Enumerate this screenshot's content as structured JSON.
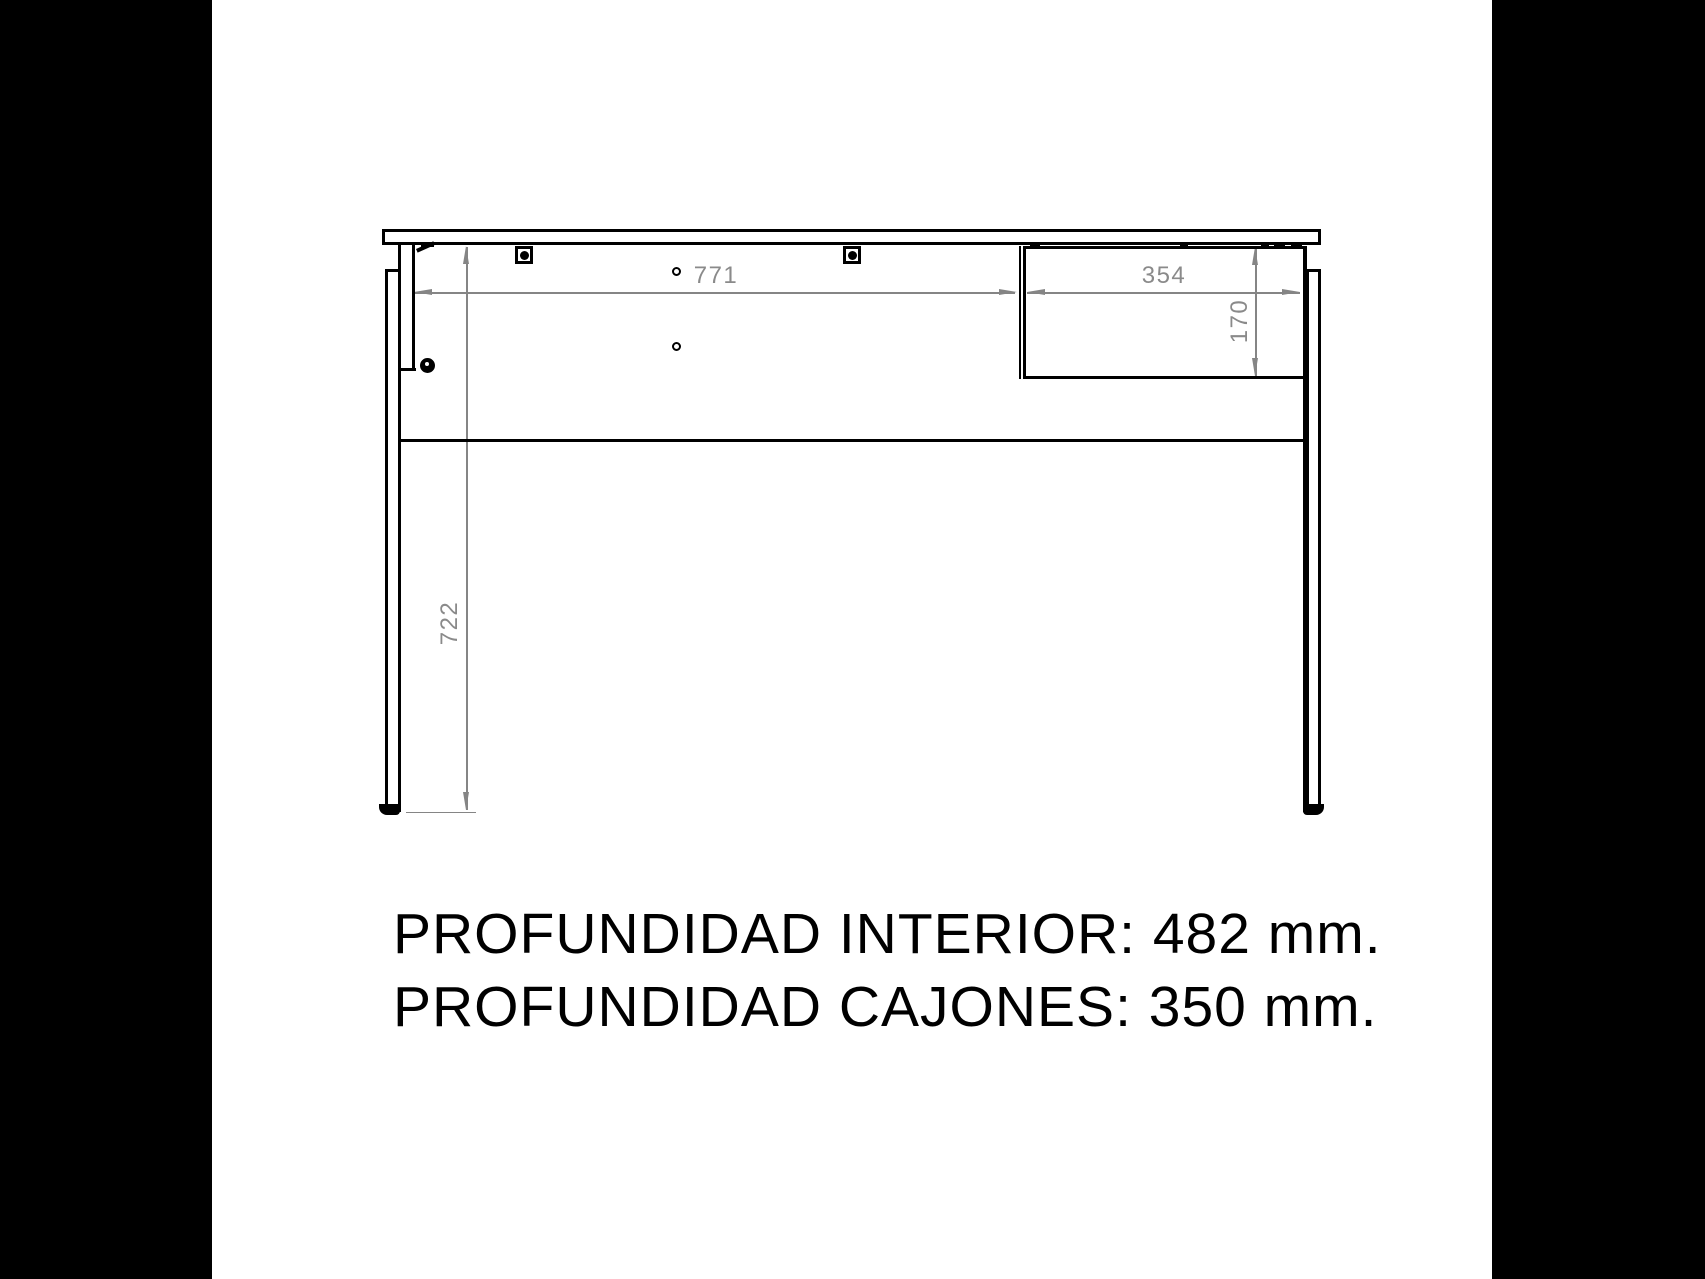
{
  "colors": {
    "background": "#ffffff",
    "letterbox": "#000000",
    "structure_line": "#000000",
    "dimension": "#858585",
    "note_text": "#000000"
  },
  "dims": {
    "interior_width": "771",
    "drawer_width": "354",
    "drawer_height": "170",
    "height_under_top": "722"
  },
  "notes": {
    "line1": "PROFUNDIDAD INTERIOR: 482 mm.",
    "line2": "PROFUNDIDAD CAJONES: 350 mm."
  }
}
